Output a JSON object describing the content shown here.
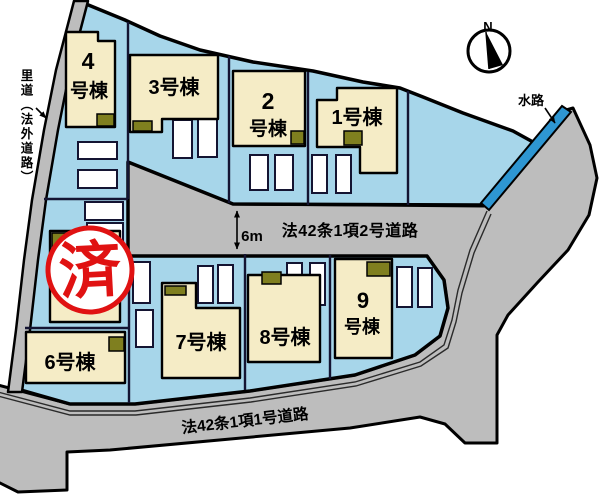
{
  "compass": {
    "north_label": "N"
  },
  "stamp": {
    "text": "済"
  },
  "annotations": {
    "satomichi_label": "里道（法外道路）",
    "waterway_label": "水路",
    "road_width_label": "6m",
    "middle_road_label": "法42条1項2号道路",
    "bottom_road_label": "法42条1項1号道路"
  },
  "buildings": [
    {
      "name": "1号棟",
      "line1": "1号棟"
    },
    {
      "name": "2号棟",
      "line1": "2",
      "line2": "号棟"
    },
    {
      "name": "3号棟",
      "line1": "3号棟"
    },
    {
      "name": "4号棟",
      "line1": "4",
      "line2": "号棟"
    },
    {
      "name": "6号棟",
      "line1": "6号棟"
    },
    {
      "name": "7号棟",
      "line1": "7号棟"
    },
    {
      "name": "8号棟",
      "line1": "8号棟"
    },
    {
      "name": "9号棟",
      "line1": "9",
      "line2": "号棟"
    }
  ],
  "colors": {
    "land": "#a7d6ea",
    "road": "#bdbdbd",
    "building": "#f5ecc6",
    "porch": "#7f7f1f",
    "waterway": "#2e96d2",
    "stamp_red": "#e01212",
    "lot_line": "#141432",
    "outline": "#000000"
  }
}
